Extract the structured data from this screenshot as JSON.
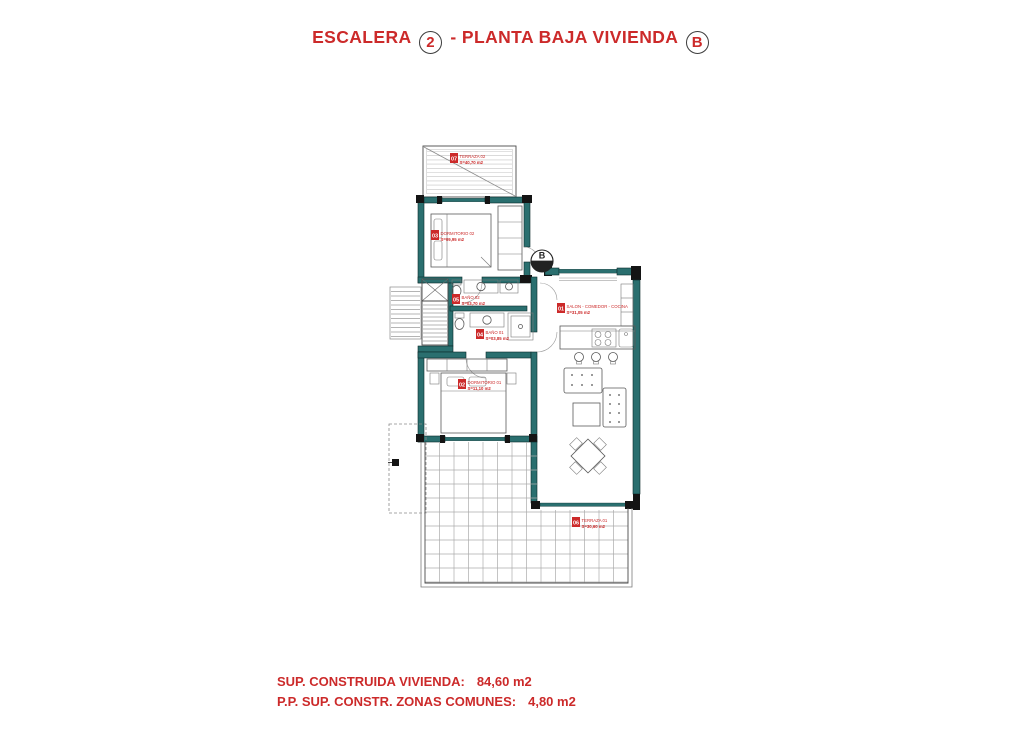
{
  "title": {
    "part1": "ESCALERA",
    "circle1": "2",
    "part2": "- PLANTA BAJA VIVIENDA",
    "circle2": "B"
  },
  "footer": {
    "line1_label": "SUP. CONSTRUIDA VIVIENDA:",
    "line1_value": "84,60 m2",
    "line2_label": "P.P. SUP. CONSTR. ZONAS COMUNES:",
    "line2_value": "4,80 m2"
  },
  "entrance_marker": {
    "letter": "B"
  },
  "rooms": [
    {
      "num": "07",
      "name": "TERRAZA 02",
      "area": "S=40,70 m2"
    },
    {
      "num": "03",
      "name": "DORMITORIO 02",
      "area": "S=09,95 m2"
    },
    {
      "num": "05",
      "name": "BAÑO 02",
      "area": "S=03,70 m2"
    },
    {
      "num": "04",
      "name": "BAÑO 01",
      "area": "S=03,85 m2"
    },
    {
      "num": "02",
      "name": "DORMITORIO 01",
      "area": "S=11,10 m2"
    },
    {
      "num": "01",
      "name": "SALON - COMEDOR - COCINA",
      "area": "S=31,05 m2"
    },
    {
      "num": "06",
      "name": "TERRAZA 01",
      "area": "S=30,60 m2"
    }
  ],
  "colors": {
    "accent_red": "#cc2a2a",
    "wall_teal": "#2a6f6f",
    "grid_gray": "#ababab"
  }
}
